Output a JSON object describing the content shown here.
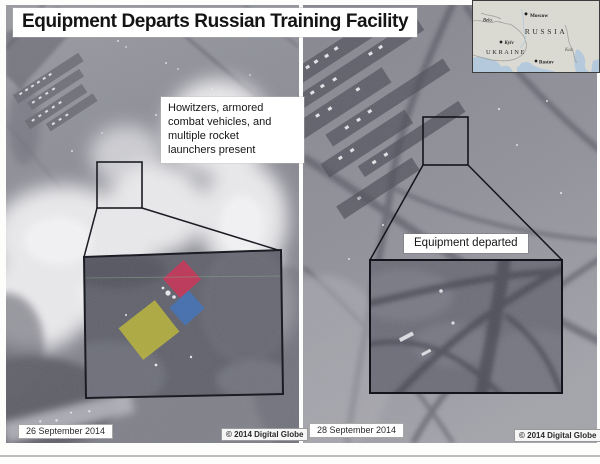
{
  "page": {
    "title": "Equipment Departs Russian Training Facility"
  },
  "map_inset": {
    "countries": [
      {
        "label": "RUSSIA"
      },
      {
        "label": "UKRAINE"
      }
    ],
    "cities": [
      {
        "label": "Moscow"
      },
      {
        "label": "Kyiv"
      },
      {
        "label": "Rostov"
      }
    ],
    "regions": [
      {
        "label": "Bela."
      },
      {
        "label": "Kaz."
      }
    ]
  },
  "left_panel": {
    "date": "26 September 2014",
    "copyright": "© 2014 Digital Globe",
    "annotation": "Howitzers, armored\ncombat vehicles, and\nmultiple rocket\nlaunchers present",
    "highlights": [
      {
        "name": "red-highlight",
        "color": "#c43054"
      },
      {
        "name": "blue-highlight",
        "color": "#3f6fb2"
      },
      {
        "name": "yellow-highlight",
        "color": "#b3af3a"
      }
    ]
  },
  "right_panel": {
    "date": "28 September 2014",
    "copyright": "© 2014 Digital Globe",
    "label": "Equipment departed"
  }
}
